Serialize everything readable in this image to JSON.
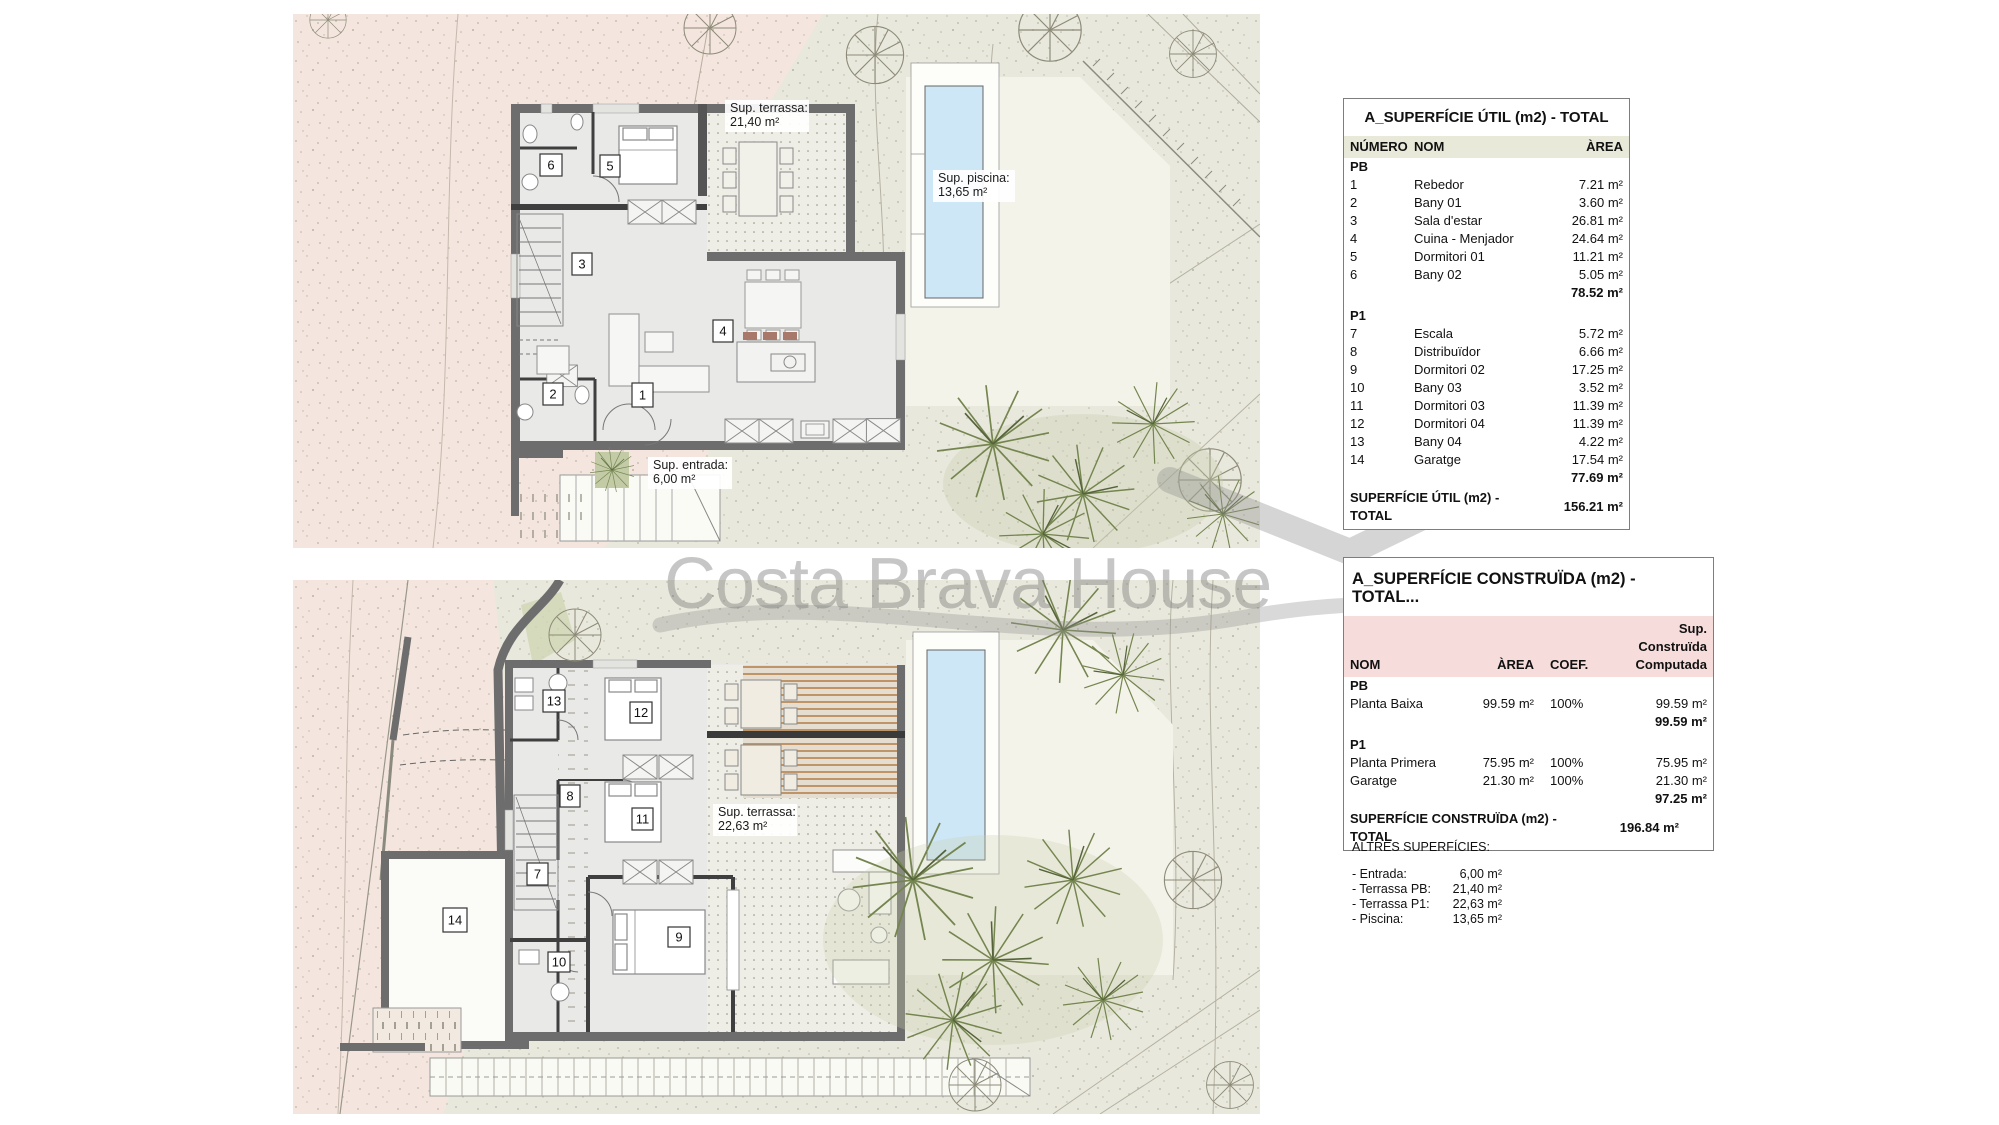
{
  "watermark": {
    "text": "Costa Brava House"
  },
  "plans": {
    "pb": {
      "rooms": [
        "1",
        "2",
        "3",
        "4",
        "5",
        "6"
      ],
      "terrace_label": {
        "line1": "Sup. terrassa:",
        "line2": "21,40 m²"
      },
      "pool_label": {
        "line1": "Sup. piscina:",
        "line2": "13,65 m²"
      },
      "entrance_label": {
        "line1": "Sup. entrada:",
        "line2": "6,00 m²"
      }
    },
    "p1": {
      "rooms": [
        "7",
        "8",
        "9",
        "10",
        "11",
        "12",
        "13",
        "14"
      ],
      "terrace_label": {
        "line1": "Sup. terrassa:",
        "line2": "22,63 m²"
      }
    }
  },
  "table_util": {
    "title": "A_SUPERFÍCIE ÚTIL (m2) - TOTAL",
    "headers": {
      "num": "NÚMERO",
      "nom": "NOM",
      "area": "ÀREA"
    },
    "section_pb": "PB",
    "rows_pb": [
      {
        "num": "1",
        "nom": "Rebedor",
        "area": "7.21 m²"
      },
      {
        "num": "2",
        "nom": "Bany 01",
        "area": "3.60 m²"
      },
      {
        "num": "3",
        "nom": "Sala d'estar",
        "area": "26.81 m²"
      },
      {
        "num": "4",
        "nom": "Cuina - Menjador",
        "area": "24.64 m²"
      },
      {
        "num": "5",
        "nom": "Dormitori 01",
        "area": "11.21 m²"
      },
      {
        "num": "6",
        "nom": "Bany 02",
        "area": "5.05 m²"
      }
    ],
    "subtotal_pb": "78.52 m²",
    "section_p1": "P1",
    "rows_p1": [
      {
        "num": "7",
        "nom": "Escala",
        "area": "5.72 m²"
      },
      {
        "num": "8",
        "nom": "Distribuïdor",
        "area": "6.66 m²"
      },
      {
        "num": "9",
        "nom": "Dormitori 02",
        "area": "17.25 m²"
      },
      {
        "num": "10",
        "nom": "Bany 03",
        "area": "3.52 m²"
      },
      {
        "num": "11",
        "nom": "Dormitori 03",
        "area": "11.39 m²"
      },
      {
        "num": "12",
        "nom": "Dormitori 04",
        "area": "11.39 m²"
      },
      {
        "num": "13",
        "nom": "Bany 04",
        "area": "4.22 m²"
      },
      {
        "num": "14",
        "nom": "Garatge",
        "area": "17.54 m²"
      }
    ],
    "subtotal_p1": "77.69 m²",
    "total_label": "SUPERFÍCIE ÚTIL (m2) - TOTAL",
    "total_value": "156.21 m²"
  },
  "table_construida": {
    "title": "A_SUPERFÍCIE CONSTRUÏDA (m2) - TOTAL...",
    "headers": {
      "nom": "NOM",
      "area": "ÀREA",
      "coef": "COEF.",
      "sup": "Sup. Construïda\nComputada"
    },
    "section_pb": "PB",
    "rows_pb": [
      {
        "nom": "Planta Baixa",
        "area": "99.59 m²",
        "coef": "100%",
        "sup": "99.59 m²"
      }
    ],
    "subtotal_pb": "99.59 m²",
    "section_p1": "P1",
    "rows_p1": [
      {
        "nom": "Planta Primera",
        "area": "75.95 m²",
        "coef": "100%",
        "sup": "75.95 m²"
      },
      {
        "nom": "Garatge",
        "area": "21.30 m²",
        "coef": "100%",
        "sup": "21.30 m²"
      }
    ],
    "subtotal_p1": "97.25 m²",
    "total_label": "SUPERFÍCIE CONSTRUÏDA (m2) - TOTAL",
    "total_value": "196.84 m²"
  },
  "altres": {
    "title": "ALTRES SUPERFÍCIES:",
    "items": [
      {
        "label": "- Entrada:",
        "value": "6,00 m²"
      },
      {
        "label": "- Terrassa PB:",
        "value": "21,40 m²"
      },
      {
        "label": "- Terrassa P1:",
        "value": "22,63 m²"
      },
      {
        "label": "- Piscina:",
        "value": "13,65 m²"
      }
    ]
  },
  "colors": {
    "terrain_green": "#e9e8dc",
    "terrain_pink": "#f4e6de",
    "wall_gray": "#6d6d6d",
    "pool_blue": "#cde7f6",
    "table_util_header_bg": "#e9e9da",
    "table_cons_header_bg": "#f7dcdc",
    "watermark_gray": "#9e9e9e"
  }
}
